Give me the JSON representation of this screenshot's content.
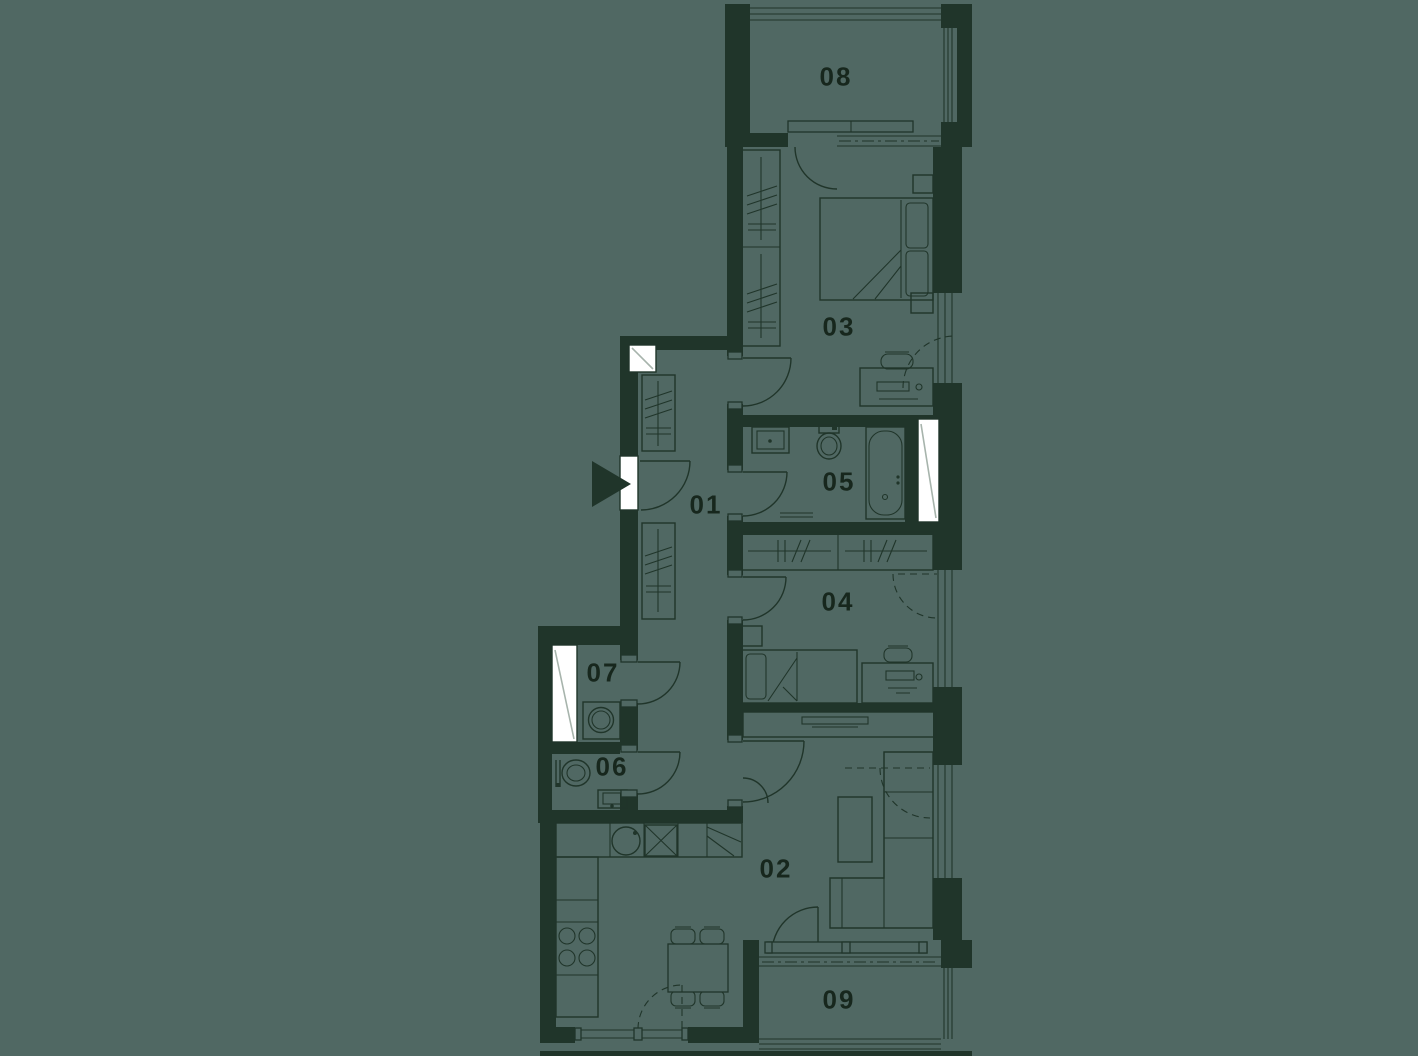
{
  "rooms": [
    {
      "label": "01"
    },
    {
      "label": "02"
    },
    {
      "label": "03"
    },
    {
      "label": "04"
    },
    {
      "label": "05"
    },
    {
      "label": "06"
    },
    {
      "label": "07"
    },
    {
      "label": "08"
    },
    {
      "label": "09"
    }
  ],
  "colors": {
    "background": "#506863",
    "floor": "#506863",
    "wall": "#20352A",
    "line": "#20352A",
    "label_text": "#17271D",
    "shaft_fill": "#FFFFFF",
    "shaft_line": "#A7B4AC"
  },
  "icons": {
    "entrance_arrow": "filled-triangle-right",
    "shaft": "white-rectangle-with-diagonal",
    "door": "quarter-circle-swing",
    "window": "parallel-glazing-lines"
  }
}
